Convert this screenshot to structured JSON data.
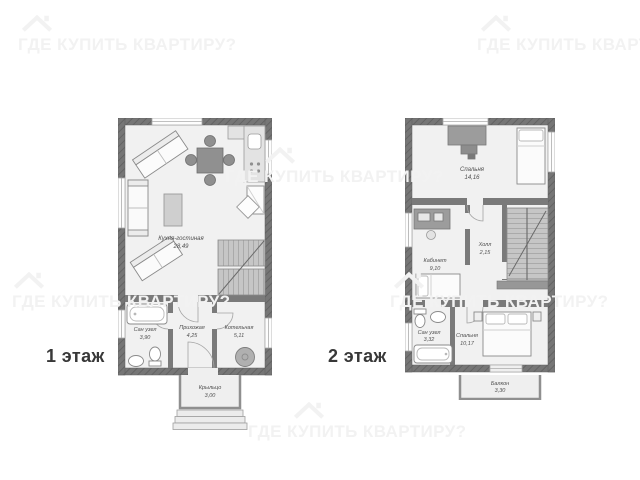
{
  "watermark": {
    "text": "ГДЕ КУПИТЬ КВАРТИРУ?",
    "icon": "house-icon",
    "color": "#f2f2f2"
  },
  "colors": {
    "wall": "#767676",
    "floor": "#f1f1f1",
    "stairs": "#c6c6c6",
    "label_text": "#4f4f4f",
    "floor_label_text": "#383838",
    "background": "#ffffff"
  },
  "floor1": {
    "label": "1 этаж",
    "rooms": {
      "living": {
        "name": "Кухня-гостиная",
        "area": "28,49"
      },
      "bath": {
        "name": "Сан узел",
        "area": "3,90"
      },
      "hallway": {
        "name": "Прихожая",
        "area": "4,25"
      },
      "boiler": {
        "name": "Котельная",
        "area": "5,11"
      },
      "porch": {
        "name": "Крыльцо",
        "area": "3,00"
      }
    }
  },
  "floor2": {
    "label": "2 этаж",
    "rooms": {
      "bedroom1": {
        "name": "Спальня",
        "area": "14,16"
      },
      "study": {
        "name": "Кабинет",
        "area": "9,10"
      },
      "hall": {
        "name": "Холл",
        "area": "2,15"
      },
      "bath": {
        "name": "Сан узел",
        "area": "3,32"
      },
      "bedroom2": {
        "name": "Спальня",
        "area": "10,17"
      },
      "balcony": {
        "name": "Балкон",
        "area": "3,30"
      }
    }
  }
}
